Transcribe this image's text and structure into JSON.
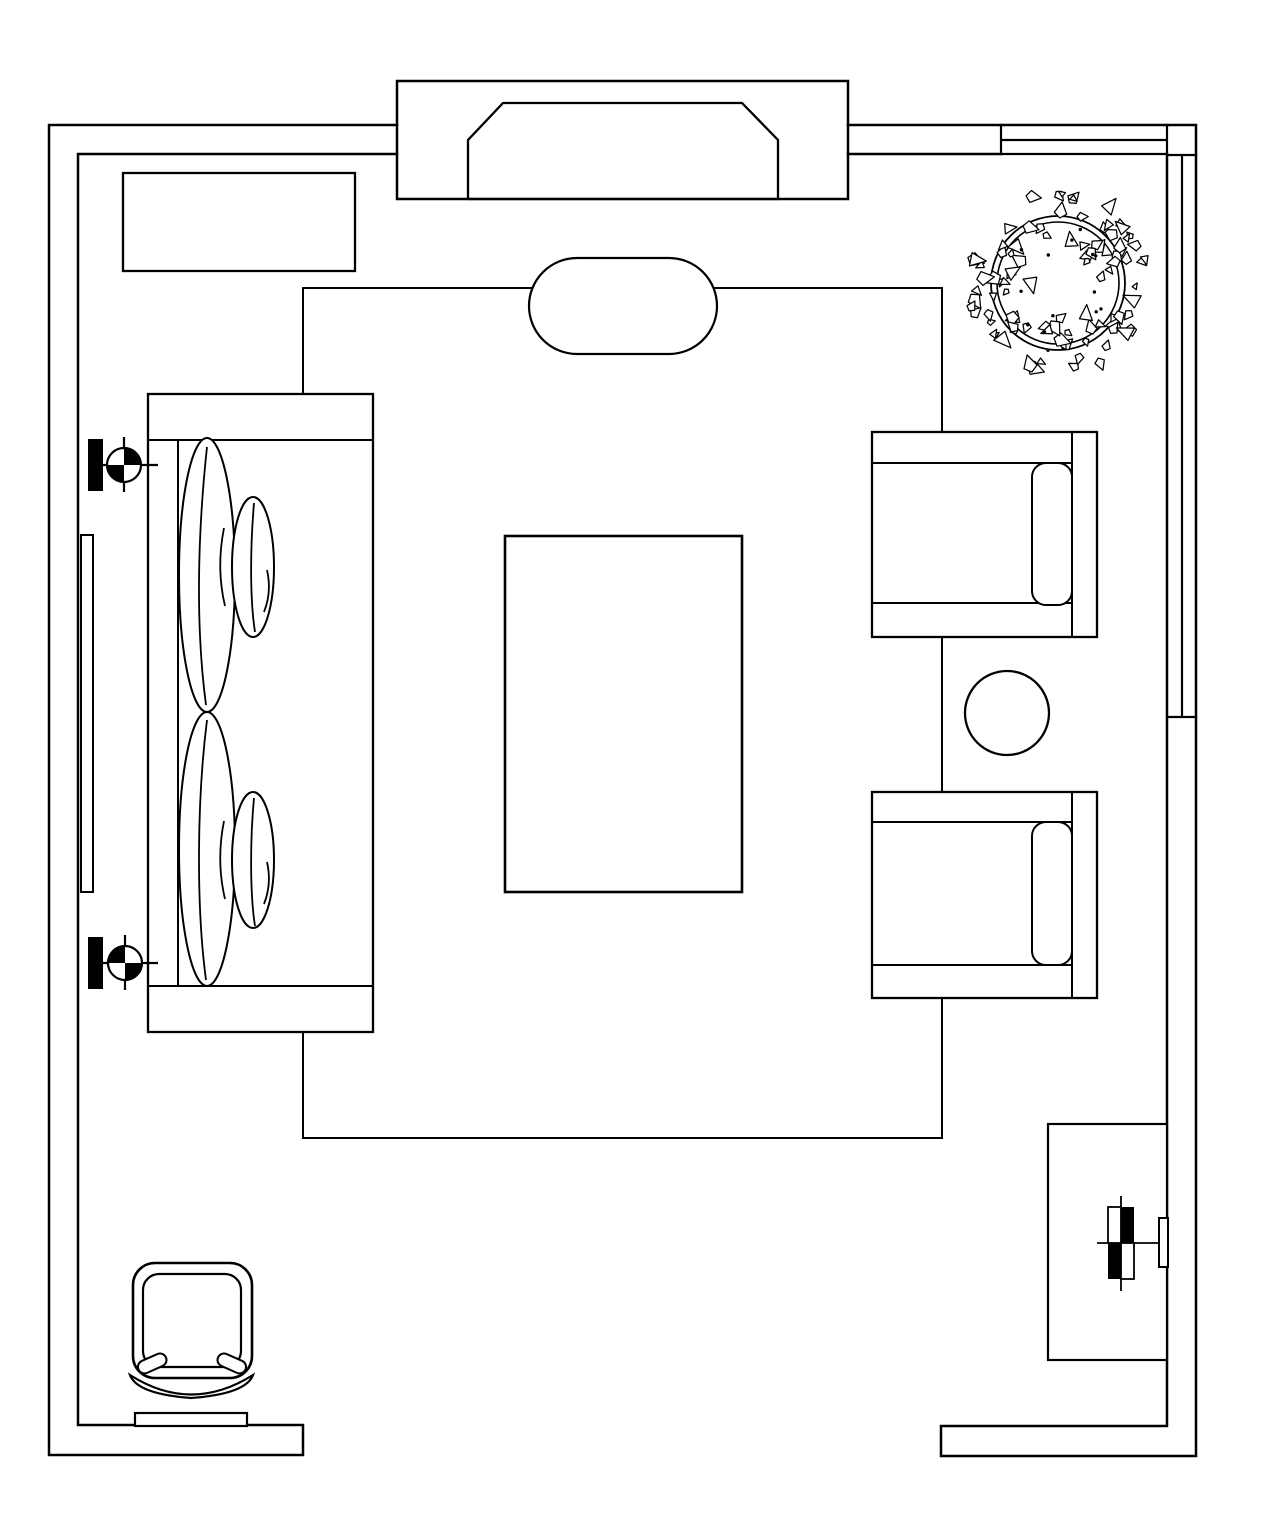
{
  "canvas": {
    "width": 1267,
    "height": 1536,
    "background": "#ffffff",
    "ink": "#000000"
  },
  "plan": {
    "type": "floor-plan",
    "view": "top-down",
    "room": "living-room",
    "visible_text": ""
  },
  "plant": {
    "cx": 1058,
    "cy": 283,
    "outer_radius": 67,
    "inner_radius": 61,
    "leaf_count": 96,
    "dot_count": 14,
    "seed": 1337
  },
  "items": {
    "walls": {
      "label": "Room walls"
    },
    "bay": {
      "label": "Bay recess with hearth"
    },
    "top_window": {
      "label": "Window in top wall"
    },
    "right_window": {
      "label": "Window in right wall"
    },
    "rug": {
      "label": "Area rug outline"
    },
    "ottoman": {
      "label": "Oval ottoman"
    },
    "sofa": {
      "label": "Sofa with cushions and pillows"
    },
    "armchair_top": {
      "label": "Armchair (upper)"
    },
    "armchair_bottom": {
      "label": "Armchair (lower)"
    },
    "side_table": {
      "label": "Round side table"
    },
    "coffee_table": {
      "label": "Coffee table"
    },
    "console": {
      "label": "Console cabinet"
    },
    "plant_item": {
      "label": "Potted plant"
    },
    "door_panel": {
      "label": "Sliding door panel"
    },
    "target_upper": {
      "label": "Center target symbol (upper)"
    },
    "target_lower": {
      "label": "Center target symbol (lower)"
    },
    "corner_chair": {
      "label": "Corner chair"
    },
    "chair_base": {
      "label": "Floor threshold"
    },
    "media_cabinet": {
      "label": "Cabinet on right wall"
    },
    "fixture": {
      "label": "Wall fixture symbol"
    },
    "jamb": {
      "label": "Jamb block"
    }
  }
}
